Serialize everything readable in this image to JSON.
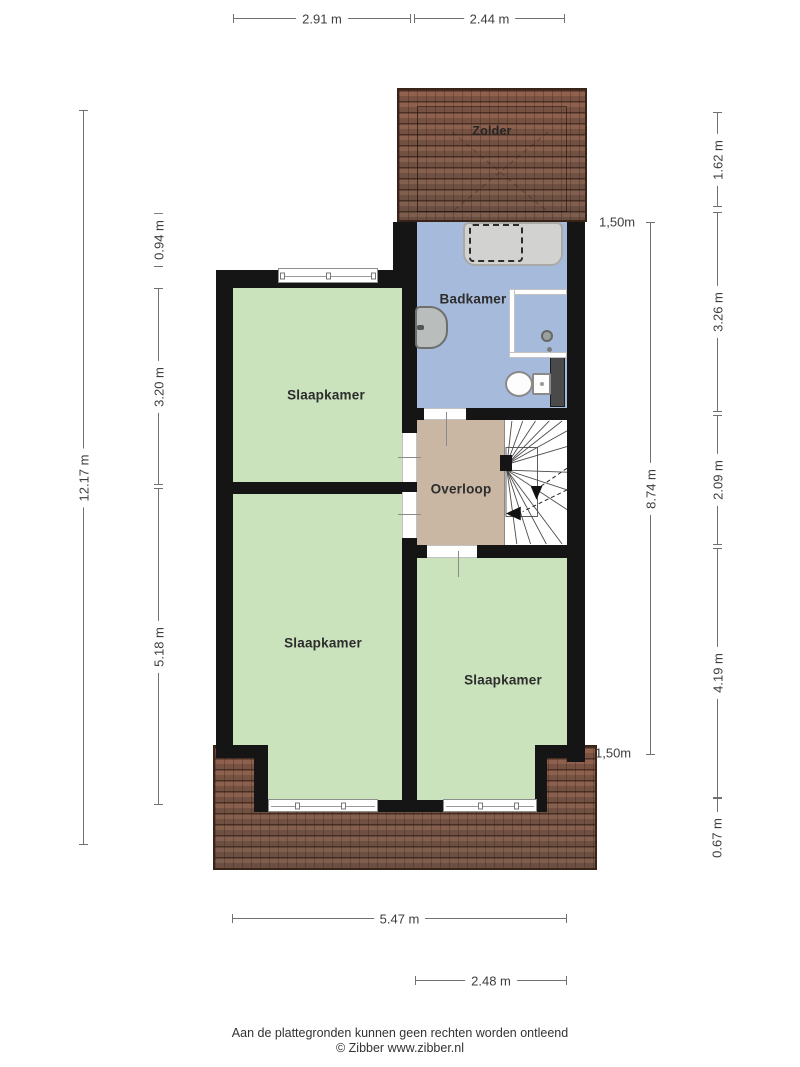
{
  "rooms": {
    "zolder": "Zolder",
    "badkamer": "Badkamer",
    "overloop": "Overloop",
    "slaapkamer_top_left": "Slaapkamer",
    "slaapkamer_bottom_left": "Slaapkamer",
    "slaapkamer_bottom_right": "Slaapkamer"
  },
  "dimensions": {
    "top_width_left": "2.91 m",
    "top_width_right": "2.44 m",
    "total_height_left": "12.17 m",
    "left_upper": "0.94 m",
    "left_middle": "3.20 m",
    "left_lower": "5.18 m",
    "inner_height_right": "8.74 m",
    "headroom_line_top": "1,50m",
    "headroom_line_bottom": "1,50m",
    "right_zolder": "1.62 m",
    "right_badkamer": "3.26 m",
    "right_overloop": "2.09 m",
    "right_slaapkamer": "4.19 m",
    "right_roof_edge": "0.67 m",
    "bottom_width_total": "5.47 m",
    "bottom_width_right": "2.48 m"
  },
  "footer": {
    "disclaimer": "Aan de plattegronden kunnen geen rechten worden ontleend",
    "copyright": "© Zibber www.zibber.nl"
  },
  "colors": {
    "bedroom_floor": "#cbe3bc",
    "bathroom_floor": "#a6badb",
    "landing_floor": "#c9b7a3",
    "roof": "#8f6b59",
    "wall": "#151515"
  }
}
